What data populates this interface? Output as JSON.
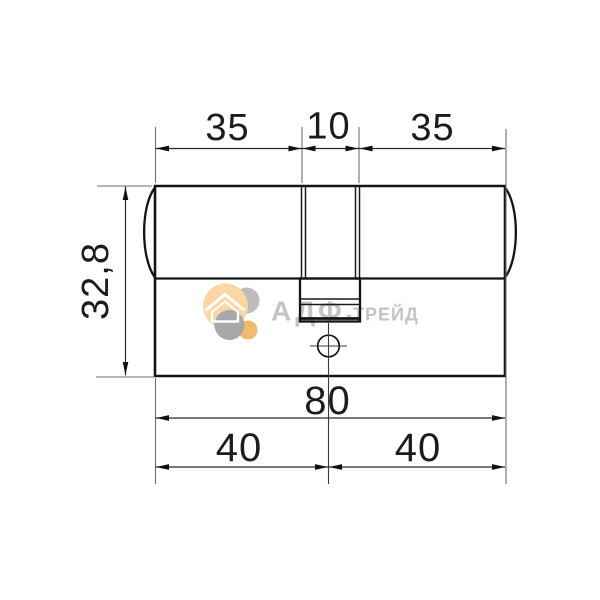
{
  "drawing": {
    "title": "lock-cylinder-dimension-drawing",
    "units": "mm",
    "dim_top_left": "35",
    "dim_top_center": "10",
    "dim_top_right": "35",
    "dim_height": "32,8",
    "dim_total_length": "80",
    "dim_bottom_left": "40",
    "dim_bottom_right": "40",
    "line_color": "#141414"
  },
  "watermark": {
    "brand_main": "АДФ",
    "brand_suffix": "-ТРЕЙД",
    "icon": "house-icon",
    "colors": {
      "circle_pale_orange": "#fad7a3",
      "circle_light_gray": "#bcbcbc",
      "circle_orange": "#f3ba6e",
      "circle_gray": "#a8a8a8",
      "text": "#c4c4c4",
      "house": "#ffffff"
    }
  }
}
